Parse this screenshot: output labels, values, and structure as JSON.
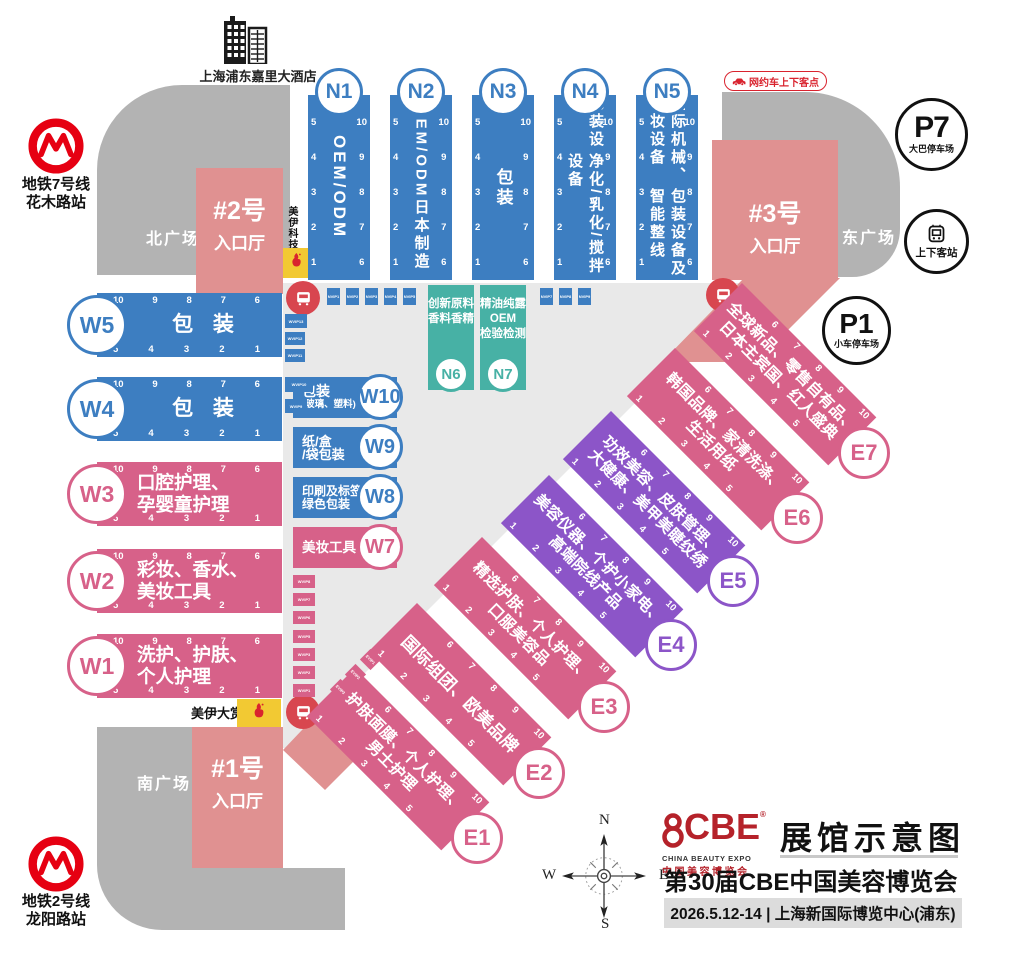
{
  "title_block": {
    "logo_word": "CBE",
    "logo_reg": "®",
    "logo_en": "CHINA BEAUTY EXPO",
    "logo_cn": "中国美容博览会",
    "title": "展馆示意图",
    "subtitle": "第30届CBE中国美容博览会",
    "date_venue": "2026.5.12-14 | 上海新国际博览中心(浦东)"
  },
  "landmarks": {
    "hotel": "上海浦东嘉里大酒店"
  },
  "stations": {
    "metro7_line1": "地铁7号线",
    "metro7_line2": "花木路站",
    "metro2_line1": "地铁2号线",
    "metro2_line2": "龙阳路站",
    "bus_stop": "上下客站",
    "ride_hailing": "网约车上下客点"
  },
  "parking": {
    "p7_id": "P7",
    "p7_label": "大巴停车场",
    "p1_id": "P1",
    "p1_label": "小车停车场"
  },
  "plazas": {
    "north": "北广场",
    "east": "东广场",
    "south": "南广场"
  },
  "entrances": {
    "no2": {
      "no": "#2号",
      "hall": "入口厅"
    },
    "no3": {
      "no": "#3号",
      "hall": "入口厅"
    },
    "no1": {
      "no": "#1号",
      "hall": "入口厅"
    }
  },
  "sponsor": {
    "tech": "美伊科技",
    "award": "美伊大赏"
  },
  "compass": {
    "n": "N",
    "e": "E",
    "s": "S",
    "w": "W"
  },
  "booth_numbers": {
    "w_top": [
      "10",
      "9",
      "8",
      "7",
      "6"
    ],
    "w_bottom": [
      "5",
      "4",
      "3",
      "2",
      "1"
    ],
    "n_left": [
      "5",
      "4",
      "3",
      "2",
      "1"
    ],
    "n_right": [
      "10",
      "9",
      "8",
      "7",
      "6"
    ],
    "e_top": [
      "6",
      "7",
      "8",
      "9",
      "10"
    ],
    "e_bottom": [
      "1",
      "2",
      "3",
      "4",
      "5"
    ]
  },
  "halls_n": [
    {
      "id": "N1",
      "lines": [
        "OEM/ODM"
      ]
    },
    {
      "id": "N2",
      "lines": [
        "OEM/ODM",
        "日本制造"
      ]
    },
    {
      "id": "N3",
      "lines": [
        "包装"
      ]
    },
    {
      "id": "N4",
      "lines": [
        "包装设备",
        "净化/乳化/搅拌设备"
      ]
    },
    {
      "id": "N5",
      "lines": [
        "国际机械、彩妆设备",
        "包装设备及智能整线"
      ]
    }
  ],
  "halls_teal": [
    {
      "id": "N6",
      "lines": [
        "创新原料",
        "香料香精"
      ]
    },
    {
      "id": "N7",
      "lines": [
        "精油纯露",
        "OEM",
        "检验检测"
      ]
    }
  ],
  "halls_w": [
    {
      "id": "W5",
      "lines": [
        "包 装"
      ],
      "theme": "blue"
    },
    {
      "id": "W4",
      "lines": [
        "包 装"
      ],
      "theme": "blue"
    },
    {
      "id": "W3",
      "lines": [
        "口腔护理、",
        "孕婴童护理"
      ],
      "theme": "pink"
    },
    {
      "id": "W2",
      "lines": [
        "彩妆、香水、",
        "美妆工具"
      ],
      "theme": "pink"
    },
    {
      "id": "W1",
      "lines": [
        "洗护、护肤、",
        "个人护理"
      ],
      "theme": "pink"
    }
  ],
  "halls_w_small": [
    {
      "id": "W10",
      "lines": [
        "包装",
        "(玻璃、塑料)"
      ],
      "theme": "blue"
    },
    {
      "id": "W9",
      "lines": [
        "纸/盒",
        "/袋包装"
      ],
      "theme": "blue"
    },
    {
      "id": "W8",
      "lines": [
        "印刷及标签、",
        "绿色包装"
      ],
      "theme": "blue"
    },
    {
      "id": "W7",
      "lines": [
        "美妆工具"
      ],
      "theme": "pink"
    }
  ],
  "halls_e": [
    {
      "id": "E1",
      "lines": [
        "护肤面膜、个人护理、",
        "男士护理"
      ],
      "theme": "pink"
    },
    {
      "id": "E2",
      "lines": [
        "国际组团、欧美品牌"
      ],
      "theme": "pink"
    },
    {
      "id": "E3",
      "lines": [
        "精选护肤、个人护理、",
        "口服美容品"
      ],
      "theme": "pink"
    },
    {
      "id": "E4",
      "lines": [
        "美容仪器、个护小家电、",
        "高端院线产品"
      ],
      "theme": "purple"
    },
    {
      "id": "E5",
      "lines": [
        "功效美容、皮肤管理、",
        "大健康、美甲美睫纹绣"
      ],
      "theme": "purple"
    },
    {
      "id": "E6",
      "lines": [
        "韩国品牌、家清洗涤、",
        "生活用纸"
      ],
      "theme": "pink"
    },
    {
      "id": "E7",
      "lines": [
        "全球新品、零售自有品、",
        "日本主宾国、红人盛典"
      ],
      "theme": "pink"
    }
  ],
  "vip": {
    "nvip_top": [
      "NVIP1",
      "NVIP2",
      "NVIP3",
      "NVIP4",
      "NVIP5"
    ],
    "nvip_right": [
      "NVIP7",
      "NVIP8",
      "NVIP9"
    ],
    "wvip_blue": [
      "WVIP13",
      "WVIP12",
      "WVIP11",
      "WVIP10",
      "WVIP9"
    ],
    "wvip_pink": [
      "WVIP8",
      "WVIP7",
      "WVIP6",
      "WVIP5",
      "WVIP3",
      "WVIP2",
      "WVIP1"
    ],
    "evip": [
      "EVIP3",
      "EVIP2",
      "EVIP1"
    ]
  },
  "colors": {
    "blue": "#3d7ec1",
    "teal": "#47b1a5",
    "pink": "#d76189",
    "purple": "#8c55c8",
    "salmon": "#e09191",
    "gray_plaza": "#b3b3b3",
    "gray_concourse": "#e9e9e9",
    "yellow": "#f2c933",
    "red": "#d9232e",
    "bus_red": "#d8464f",
    "logo_red": "#b5222a"
  }
}
